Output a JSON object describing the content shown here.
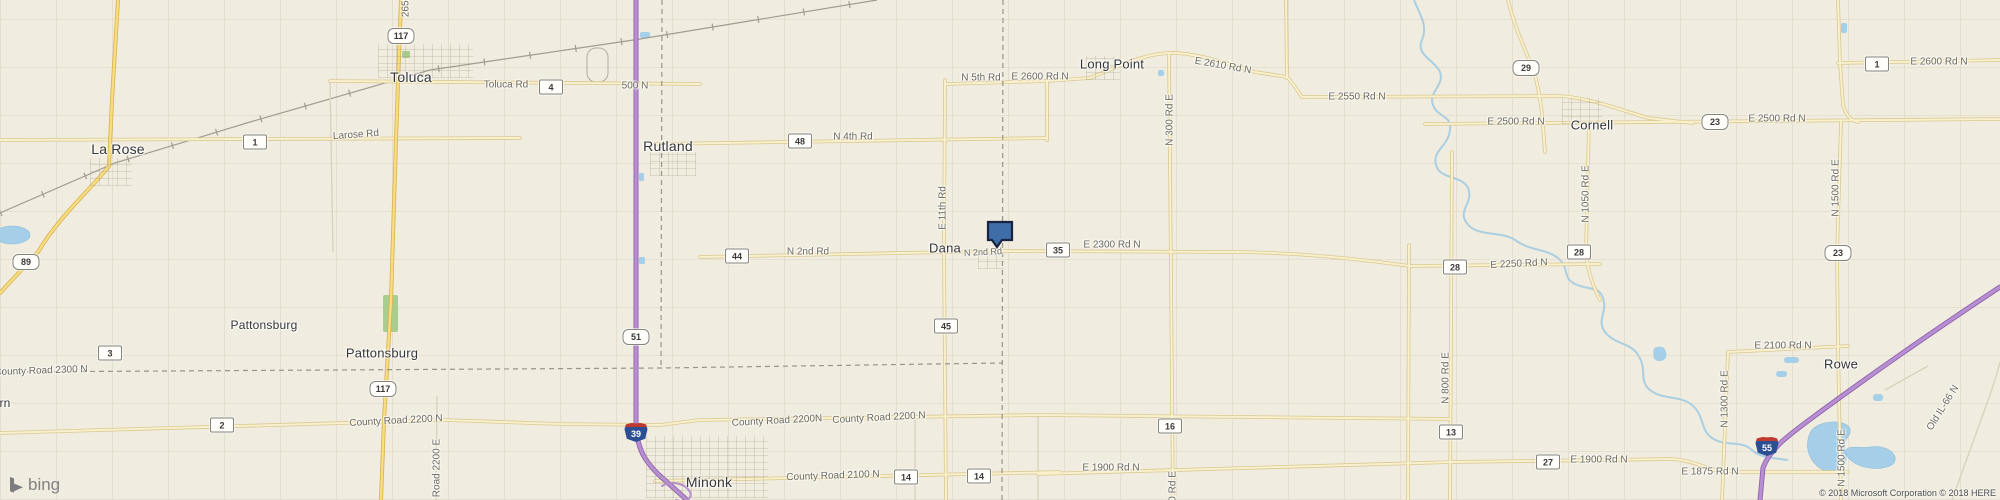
{
  "map": {
    "attribution": "© 2018 Microsoft Corporation © 2018 HERE",
    "logo_text": "bing",
    "colors": {
      "land": "#f0ecdf",
      "interstate_purple": "#b78ed2",
      "county_road_tan": "#f9f0ce",
      "state_route_yellow": "#f7dd7f",
      "water_blue": "#a5cfe8",
      "marker_fill": "#3f6da8",
      "marker_border": "#17233f"
    },
    "marker": {
      "description": "selected parcel pin at Dana",
      "fill": "#3f6da8",
      "border": "#17233f",
      "points": "988,222 1012,222 1012,240 1002,240 997,247 992,240 988,240"
    },
    "towns": [
      {
        "t": "Toluca",
        "x": 411,
        "y": 77,
        "s": 14
      },
      {
        "t": "La Rose",
        "x": 118,
        "y": 149,
        "s": 14
      },
      {
        "t": "Rutland",
        "x": 668,
        "y": 146,
        "s": 14
      },
      {
        "t": "Long Point",
        "x": 1112,
        "y": 64,
        "s": 13
      },
      {
        "t": "Cornell",
        "x": 1592,
        "y": 125,
        "s": 13
      },
      {
        "t": "Dana",
        "x": 945,
        "y": 248,
        "s": 13
      },
      {
        "t": "Pattonsburg",
        "x": 264,
        "y": 325,
        "s": 12
      },
      {
        "t": "Pattonsburg",
        "x": 382,
        "y": 353,
        "s": 13
      },
      {
        "t": "Minonk",
        "x": 709,
        "y": 482,
        "s": 14
      },
      {
        "t": "Rowe",
        "x": 1841,
        "y": 364,
        "s": 13
      },
      {
        "t": "rn",
        "x": 5,
        "y": 403,
        "s": 12
      }
    ],
    "road_labels": [
      {
        "t": "Toluca Rd",
        "x": 506,
        "y": 85
      },
      {
        "t": "500 N",
        "x": 635,
        "y": 86
      },
      {
        "t": "Larose Rd",
        "x": 356,
        "y": 135,
        "r": -4
      },
      {
        "t": "N 4th Rd",
        "x": 853,
        "y": 137
      },
      {
        "t": "N 5th Rd",
        "x": 981,
        "y": 78
      },
      {
        "t": "E 2600 Rd N",
        "x": 1040,
        "y": 77
      },
      {
        "t": "E 2610 Rd N",
        "x": 1223,
        "y": 66,
        "r": 10
      },
      {
        "t": "E 2550 Rd N",
        "x": 1357,
        "y": 97
      },
      {
        "t": "E 2500 Rd N",
        "x": 1516,
        "y": 122
      },
      {
        "t": "E 2500 Rd N",
        "x": 1777,
        "y": 119
      },
      {
        "t": "E 2600 Rd N",
        "x": 1939,
        "y": 62
      },
      {
        "t": "N 2nd Rd",
        "x": 808,
        "y": 252
      },
      {
        "t": "N 2nd Rd",
        "x": 983,
        "y": 252,
        "s": 9,
        "r": -3
      },
      {
        "t": "E 2300 Rd N",
        "x": 1112,
        "y": 245
      },
      {
        "t": "E 2250 Rd N",
        "x": 1519,
        "y": 264,
        "r": -3
      },
      {
        "t": "E 2100 Rd N",
        "x": 1783,
        "y": 346
      },
      {
        "t": "E 1900 Rd N",
        "x": 1111,
        "y": 468
      },
      {
        "t": "E 1900 Rd N",
        "x": 1599,
        "y": 460
      },
      {
        "t": "E 1875 Rd N",
        "x": 1710,
        "y": 472
      },
      {
        "t": "County Road 2300 N",
        "x": 41,
        "y": 371,
        "r": -2
      },
      {
        "t": "County Road 2200 N",
        "x": 396,
        "y": 421,
        "r": -3
      },
      {
        "t": "County Road 2200N",
        "x": 777,
        "y": 421,
        "r": -3
      },
      {
        "t": "County Road 2200 N",
        "x": 879,
        "y": 418,
        "r": -3
      },
      {
        "t": "County Road 2100 N",
        "x": 833,
        "y": 476,
        "r": -2
      },
      {
        "t": "N 300 Rd E",
        "x": 1170,
        "y": 120,
        "r": -90
      },
      {
        "t": "N 300 Rd E",
        "x": 1173,
        "y": 497,
        "r": -90
      },
      {
        "t": "E 11th Rd",
        "x": 943,
        "y": 208,
        "r": -90
      },
      {
        "t": "N 800 Rd E",
        "x": 1446,
        "y": 378,
        "r": -90
      },
      {
        "t": "N 1050 Rd E",
        "x": 1586,
        "y": 194,
        "r": -90
      },
      {
        "t": "N 1500 Rd E",
        "x": 1836,
        "y": 188,
        "r": -90
      },
      {
        "t": "N 1500 Rd E",
        "x": 1842,
        "y": 458,
        "r": -90
      },
      {
        "t": "N 1300 Rd E",
        "x": 1725,
        "y": 399,
        "r": -90
      },
      {
        "t": "Old IL-66 N",
        "x": 1943,
        "y": 408,
        "r": -58
      },
      {
        "t": "Road 2200 E",
        "x": 437,
        "y": 468,
        "r": -90
      },
      {
        "t": "2650",
        "x": 406,
        "y": 6,
        "r": -90
      }
    ],
    "route_shields_box": [
      {
        "n": "1",
        "x": 255,
        "y": 142
      },
      {
        "n": "4",
        "x": 551,
        "y": 87
      },
      {
        "n": "48",
        "x": 800,
        "y": 141
      },
      {
        "n": "44",
        "x": 737,
        "y": 256
      },
      {
        "n": "35",
        "x": 1058,
        "y": 250
      },
      {
        "n": "45",
        "x": 946,
        "y": 326
      },
      {
        "n": "3",
        "x": 110,
        "y": 353
      },
      {
        "n": "2",
        "x": 222,
        "y": 425
      },
      {
        "n": "14",
        "x": 906,
        "y": 477
      },
      {
        "n": "14",
        "x": 979,
        "y": 476
      },
      {
        "n": "16",
        "x": 1170,
        "y": 426
      },
      {
        "n": "13",
        "x": 1451,
        "y": 432
      },
      {
        "n": "28",
        "x": 1455,
        "y": 267
      },
      {
        "n": "28",
        "x": 1579,
        "y": 252
      },
      {
        "n": "27",
        "x": 1548,
        "y": 462
      },
      {
        "n": "1",
        "x": 1877,
        "y": 64
      }
    ],
    "route_shields_round": [
      {
        "n": "117",
        "x": 401,
        "y": 36
      },
      {
        "n": "117",
        "x": 383,
        "y": 389
      },
      {
        "n": "89",
        "x": 26,
        "y": 262
      },
      {
        "n": "51",
        "x": 636,
        "y": 337
      },
      {
        "n": "29",
        "x": 1526,
        "y": 68
      },
      {
        "n": "23",
        "x": 1715,
        "y": 122
      },
      {
        "n": "23",
        "x": 1838,
        "y": 253
      }
    ],
    "interstate_shields": [
      {
        "n": "39",
        "x": 636,
        "y": 432
      },
      {
        "n": "55",
        "x": 1767,
        "y": 446
      }
    ]
  }
}
